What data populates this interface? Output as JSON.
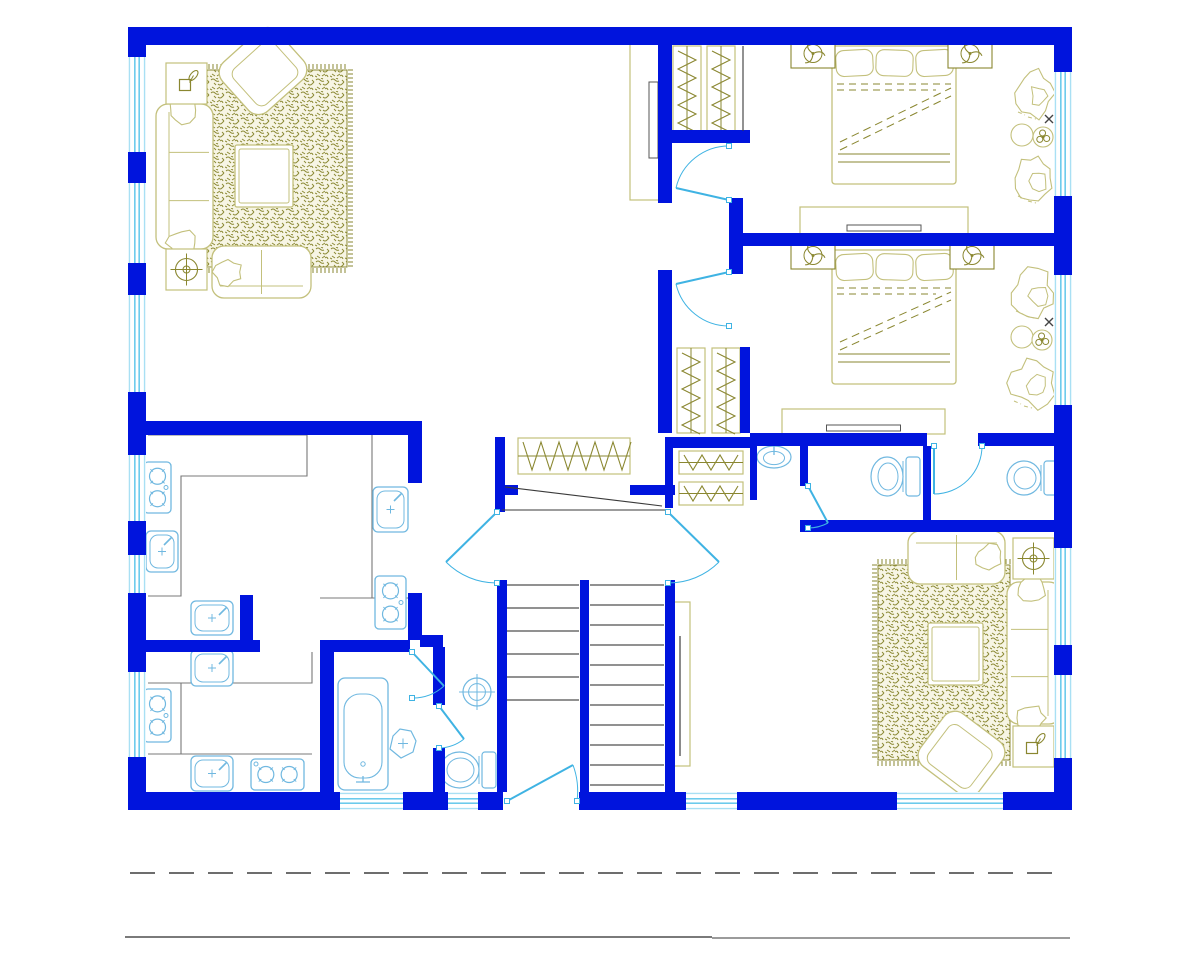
{
  "canvas": {
    "width": 1200,
    "height": 960
  },
  "colors": {
    "paper": "#ffffff",
    "wall": "#0014dd",
    "window": "#56c3e9",
    "window_light": "#a9e0f4",
    "door": "#3fb3e3",
    "fixture": "#70b8e0",
    "counter": "#787878",
    "stair": "#4f4f4f",
    "dark": "#3a3a3a",
    "khaki": "#c3c07c",
    "khaki_dark": "#8a8730",
    "rug_ink": "#8c8a36",
    "section_dash": "#3d3d3d",
    "ground_left": "#4f4f4f",
    "ground_right": "#9b9b9b"
  },
  "plan": {
    "outer_walls": [
      {
        "name": "top-wall",
        "x": 128,
        "y": 27,
        "w": 944,
        "h": 18
      },
      {
        "name": "bottom-wall",
        "x": 128,
        "y": 792,
        "w": 944,
        "h": 18
      },
      {
        "name": "left-wall",
        "x": 128,
        "y": 27,
        "w": 18,
        "h": 783
      },
      {
        "name": "right-wall",
        "x": 1054,
        "y": 27,
        "w": 18,
        "h": 783
      }
    ],
    "inner_walls": [
      {
        "x": 658,
        "y": 45,
        "w": 14,
        "h": 95
      },
      {
        "x": 658,
        "y": 130,
        "w": 92,
        "h": 13
      },
      {
        "x": 658,
        "y": 140,
        "w": 14,
        "h": 63
      },
      {
        "x": 658,
        "y": 270,
        "w": 14,
        "h": 163
      },
      {
        "x": 729,
        "y": 198,
        "w": 14,
        "h": 76
      },
      {
        "x": 743,
        "y": 233,
        "w": 329,
        "h": 13
      },
      {
        "x": 740,
        "y": 347,
        "w": 10,
        "h": 86
      },
      {
        "x": 672,
        "y": 437,
        "w": 78,
        "h": 11
      },
      {
        "x": 750,
        "y": 433,
        "w": 177,
        "h": 13
      },
      {
        "x": 978,
        "y": 433,
        "w": 94,
        "h": 13
      },
      {
        "x": 750,
        "y": 438,
        "w": 7,
        "h": 62
      },
      {
        "x": 800,
        "y": 446,
        "w": 8,
        "h": 40
      },
      {
        "x": 923,
        "y": 446,
        "w": 8,
        "h": 86
      },
      {
        "x": 800,
        "y": 520,
        "w": 272,
        "h": 12
      },
      {
        "x": 495,
        "y": 437,
        "w": 10,
        "h": 75
      },
      {
        "x": 665,
        "y": 437,
        "w": 8,
        "h": 71
      },
      {
        "x": 495,
        "y": 485,
        "w": 23,
        "h": 10
      },
      {
        "x": 630,
        "y": 485,
        "w": 45,
        "h": 10
      },
      {
        "x": 146,
        "y": 421,
        "w": 262,
        "h": 14
      },
      {
        "x": 408,
        "y": 421,
        "w": 14,
        "h": 62
      },
      {
        "x": 408,
        "y": 593,
        "w": 14,
        "h": 47
      },
      {
        "x": 240,
        "y": 595,
        "w": 13,
        "h": 57
      },
      {
        "x": 128,
        "y": 640,
        "w": 132,
        "h": 12
      },
      {
        "x": 320,
        "y": 640,
        "w": 14,
        "h": 152
      },
      {
        "x": 334,
        "y": 640,
        "w": 76,
        "h": 12
      },
      {
        "x": 420,
        "y": 635,
        "w": 23,
        "h": 12
      },
      {
        "x": 433,
        "y": 647,
        "w": 12,
        "h": 58
      },
      {
        "x": 433,
        "y": 748,
        "w": 12,
        "h": 44
      },
      {
        "x": 497,
        "y": 580,
        "w": 10,
        "h": 212
      },
      {
        "x": 580,
        "y": 580,
        "w": 9,
        "h": 212
      },
      {
        "x": 665,
        "y": 580,
        "w": 10,
        "h": 212
      }
    ],
    "wall_gaps": [
      {
        "x": 503,
        "y": 792,
        "w": 76,
        "h": 18
      }
    ],
    "windows": [
      {
        "o": "v",
        "x": 128,
        "y": 57,
        "w": 18,
        "h": 95
      },
      {
        "o": "v",
        "x": 128,
        "y": 183,
        "w": 18,
        "h": 80
      },
      {
        "o": "v",
        "x": 128,
        "y": 295,
        "w": 18,
        "h": 97
      },
      {
        "o": "v",
        "x": 128,
        "y": 455,
        "w": 18,
        "h": 66
      },
      {
        "o": "v",
        "x": 128,
        "y": 555,
        "w": 18,
        "h": 38
      },
      {
        "o": "v",
        "x": 128,
        "y": 672,
        "w": 18,
        "h": 85
      },
      {
        "o": "v",
        "x": 1054,
        "y": 72,
        "w": 18,
        "h": 124
      },
      {
        "o": "v",
        "x": 1054,
        "y": 275,
        "w": 18,
        "h": 130
      },
      {
        "o": "v",
        "x": 1054,
        "y": 548,
        "w": 18,
        "h": 97
      },
      {
        "o": "v",
        "x": 1054,
        "y": 675,
        "w": 18,
        "h": 83
      },
      {
        "o": "h",
        "x": 340,
        "y": 792,
        "w": 63,
        "h": 18
      },
      {
        "o": "h",
        "x": 448,
        "y": 792,
        "w": 30,
        "h": 18
      },
      {
        "o": "h",
        "x": 686,
        "y": 792,
        "w": 51,
        "h": 18
      },
      {
        "o": "h",
        "x": 897,
        "y": 792,
        "w": 106,
        "h": 18
      }
    ],
    "doors": [
      {
        "name": "bedroom1-door",
        "p": [
          729,
          200
        ],
        "e": [
          676,
          188
        ],
        "j": [
          729,
          146
        ],
        "s": 1
      },
      {
        "name": "bedroom2-door",
        "p": [
          729,
          272
        ],
        "e": [
          676,
          284
        ],
        "j": [
          729,
          326
        ],
        "s": 0
      },
      {
        "name": "wc2-door",
        "p": [
          934,
          446
        ],
        "e": [
          934,
          494
        ],
        "j": [
          982,
          446
        ],
        "s": 0
      },
      {
        "name": "wc1-door",
        "p": [
          808,
          486
        ],
        "e": [
          828,
          523
        ],
        "j": [
          808,
          528
        ],
        "s": 1
      },
      {
        "name": "hall-double-door-left",
        "p": [
          497,
          512
        ],
        "e": [
          446,
          562
        ],
        "j": [
          497,
          583
        ],
        "s": 0
      },
      {
        "name": "hall-double-door-right",
        "p": [
          668,
          512
        ],
        "e": [
          719,
          562
        ],
        "j": [
          668,
          583
        ],
        "s": 1
      },
      {
        "name": "entry-door",
        "p": [
          507,
          801
        ],
        "e": [
          573,
          765
        ],
        "j": [
          577,
          801
        ],
        "s": 1
      },
      {
        "name": "bathroom-door",
        "p": [
          412,
          652
        ],
        "e": [
          444,
          686
        ],
        "j": [
          412,
          698
        ],
        "s": 1
      },
      {
        "name": "stair-wc-door",
        "p": [
          439,
          706
        ],
        "e": [
          464,
          739
        ],
        "j": [
          439,
          748
        ],
        "s": 1
      }
    ],
    "counters": [
      "M148 435 L307 435 L307 476 L181 476 L181 596 L148 596",
      "M372 435 L372 598",
      "M320 598 L408 598",
      "M312 652 L312 683 L148 683",
      "M181 683 L181 754",
      "M148 754 L312 754"
    ],
    "gray_lines": [
      "M743 46 L743 131",
      "M505 487 L662 506",
      "M502 510 L665 510"
    ],
    "stairs": {
      "flights": [
        {
          "x1": 507,
          "x2": 579,
          "y0": 585,
          "step": 23,
          "n": 6
        },
        {
          "x1": 590,
          "x2": 664,
          "y0": 585,
          "step": 20,
          "n": 11
        }
      ],
      "rail": {
        "x": 670,
        "y": 602,
        "w": 20,
        "h": 164
      }
    },
    "furniture": [
      {
        "t": "rug",
        "name": "area-rug",
        "x": 205,
        "y": 70,
        "w": 142,
        "h": 197,
        "fringe": [
          "top",
          "right",
          "bottom"
        ]
      },
      {
        "t": "rug",
        "name": "area-rug",
        "x": 878,
        "y": 565,
        "w": 132,
        "h": 195,
        "fringe": [
          "left",
          "top",
          "bottom"
        ]
      },
      {
        "t": "coffee_table",
        "name": "coffee-table",
        "x": 235,
        "y": 145,
        "w": 58,
        "h": 62
      },
      {
        "t": "coffee_table",
        "name": "coffee-table",
        "x": 928,
        "y": 623,
        "w": 55,
        "h": 62
      },
      {
        "t": "sofa",
        "name": "sofa",
        "x": 156,
        "y": 104,
        "w": 57,
        "h": 145,
        "back": "left"
      },
      {
        "t": "sofa",
        "name": "sofa",
        "x": 1007,
        "y": 582,
        "w": 54,
        "h": 142,
        "back": "right"
      },
      {
        "t": "loveseat",
        "name": "loveseat",
        "x": 212,
        "y": 246,
        "w": 99,
        "h": 52,
        "back": "bottom",
        "pillow": "left"
      },
      {
        "t": "loveseat",
        "name": "loveseat",
        "x": 908,
        "y": 531,
        "w": 97,
        "h": 53,
        "back": "top",
        "pillow": "right"
      },
      {
        "t": "armchair",
        "name": "armchair",
        "x": 226,
        "y": 38,
        "w": 74,
        "h": 66,
        "rot": -42
      },
      {
        "t": "armchair",
        "name": "armchair",
        "x": 925,
        "y": 721,
        "w": 73,
        "h": 66,
        "rot": 37
      },
      {
        "t": "side_table",
        "name": "side-table",
        "glyph": "plant",
        "x": 166,
        "y": 63,
        "s": 41
      },
      {
        "t": "side_table",
        "name": "side-table",
        "glyph": "fan",
        "x": 166,
        "y": 249,
        "s": 41
      },
      {
        "t": "side_table",
        "name": "side-table",
        "glyph": "fan",
        "x": 1013,
        "y": 538,
        "s": 41
      },
      {
        "t": "side_table",
        "name": "side-table",
        "glyph": "plant",
        "x": 1013,
        "y": 726,
        "s": 41
      },
      {
        "t": "tv_cabinet",
        "name": "tv-cabinet",
        "x": 630,
        "y": 40,
        "w": 30,
        "h": 160
      },
      {
        "t": "bed",
        "name": "double-bed",
        "x": 832,
        "y": 46,
        "w": 124,
        "h": 138
      },
      {
        "t": "bed",
        "name": "double-bed",
        "x": 832,
        "y": 250,
        "w": 124,
        "h": 134
      },
      {
        "t": "nightstand",
        "name": "nightstand-fan",
        "x": 791,
        "y": 39,
        "w": 44,
        "h": 29
      },
      {
        "t": "nightstand",
        "name": "nightstand-fan",
        "x": 948,
        "y": 39,
        "w": 44,
        "h": 29
      },
      {
        "t": "nightstand",
        "name": "nightstand-fan",
        "x": 791,
        "y": 242,
        "w": 44,
        "h": 27
      },
      {
        "t": "nightstand",
        "name": "nightstand-fan",
        "x": 950,
        "y": 242,
        "w": 44,
        "h": 27
      },
      {
        "t": "dresser",
        "name": "dresser-tv",
        "x": 800,
        "y": 207,
        "w": 168,
        "h": 27
      },
      {
        "t": "dresser",
        "name": "dresser-tv",
        "x": 782,
        "y": 409,
        "w": 163,
        "h": 25
      },
      {
        "t": "rack",
        "name": "closet-rack",
        "o": "v",
        "x": 673,
        "y": 46,
        "w": 28,
        "h": 85
      },
      {
        "t": "rack",
        "name": "closet-rack",
        "o": "v",
        "x": 707,
        "y": 46,
        "w": 28,
        "h": 85
      },
      {
        "t": "rack",
        "name": "closet-rack",
        "o": "v",
        "x": 677,
        "y": 348,
        "w": 28,
        "h": 85
      },
      {
        "t": "rack",
        "name": "closet-rack",
        "o": "v",
        "x": 712,
        "y": 348,
        "w": 28,
        "h": 85
      },
      {
        "t": "rack",
        "name": "closet-rack",
        "o": "h",
        "x": 518,
        "y": 438,
        "w": 112,
        "h": 36
      },
      {
        "t": "rack",
        "name": "closet-rack",
        "o": "h",
        "x": 679,
        "y": 451,
        "w": 64,
        "h": 23
      },
      {
        "t": "rack",
        "name": "closet-rack",
        "o": "h",
        "x": 679,
        "y": 482,
        "w": 64,
        "h": 23
      },
      {
        "t": "plant",
        "name": "potted-plant",
        "x": 1012,
        "y": 66,
        "w": 44,
        "h": 54,
        "seed": 1
      },
      {
        "t": "plant",
        "name": "potted-plant",
        "x": 1012,
        "y": 152,
        "w": 44,
        "h": 52,
        "seed": 2
      },
      {
        "t": "plant",
        "name": "potted-plant",
        "x": 1010,
        "y": 267,
        "w": 46,
        "h": 52,
        "seed": 3
      },
      {
        "t": "plant",
        "name": "potted-plant",
        "x": 1008,
        "y": 357,
        "w": 48,
        "h": 52,
        "seed": 4
      },
      {
        "t": "plant_table",
        "name": "plant-table",
        "cx1": 1022,
        "cy1": 135,
        "cx2": 1043,
        "cy2": 137,
        "xx": 1049,
        "xy": 119
      },
      {
        "t": "plant_table",
        "name": "plant-table",
        "cx1": 1022,
        "cy1": 337,
        "cx2": 1042,
        "cy2": 340,
        "xx": 1049,
        "xy": 322
      },
      {
        "t": "stove",
        "name": "stove",
        "x": 144,
        "y": 462,
        "w": 27,
        "h": 51
      },
      {
        "t": "stove",
        "name": "stove",
        "x": 375,
        "y": 576,
        "w": 31,
        "h": 53
      },
      {
        "t": "stove",
        "name": "stove",
        "x": 144,
        "y": 689,
        "w": 27,
        "h": 53
      },
      {
        "t": "stove",
        "name": "stove",
        "x": 251,
        "y": 759,
        "w": 53,
        "h": 31
      },
      {
        "t": "sink",
        "name": "kitchen-sink",
        "x": 146,
        "y": 531,
        "w": 32,
        "h": 41
      },
      {
        "t": "sink",
        "name": "kitchen-sink",
        "x": 373,
        "y": 487,
        "w": 35,
        "h": 45
      },
      {
        "t": "sink",
        "name": "kitchen-sink",
        "x": 191,
        "y": 601,
        "w": 42,
        "h": 34
      },
      {
        "t": "sink",
        "name": "kitchen-sink",
        "x": 191,
        "y": 650,
        "w": 42,
        "h": 36
      },
      {
        "t": "sink",
        "name": "kitchen-sink",
        "x": 191,
        "y": 756,
        "w": 42,
        "h": 35
      },
      {
        "t": "tub",
        "name": "bathtub",
        "x": 338,
        "y": 678,
        "w": 50,
        "h": 112
      },
      {
        "t": "basin",
        "name": "wash-basin",
        "x": 390,
        "y": 729,
        "w": 26,
        "h": 29
      },
      {
        "t": "round_sink",
        "name": "round-sink",
        "cx": 477,
        "cy": 692,
        "r": 14
      },
      {
        "t": "oval_sink",
        "name": "oval-sink",
        "cx": 774,
        "cy": 457,
        "rx": 17,
        "ry": 11
      },
      {
        "t": "toilet",
        "name": "toilet",
        "x": 438,
        "y": 750,
        "w": 59,
        "h": 40
      },
      {
        "t": "toilet",
        "name": "toilet",
        "x": 869,
        "y": 455,
        "w": 52,
        "h": 43
      },
      {
        "t": "toilet",
        "name": "toilet",
        "x": 1005,
        "y": 459,
        "w": 54,
        "h": 38
      }
    ],
    "section_lines": {
      "dashed": {
        "x1": 130,
        "y": 873,
        "x2": 1066,
        "dash": "25 14"
      },
      "solid_left": {
        "x1": 125,
        "y": 937,
        "x2": 712
      },
      "solid_right": {
        "x1": 712,
        "y": 938,
        "x2": 1070
      }
    }
  }
}
